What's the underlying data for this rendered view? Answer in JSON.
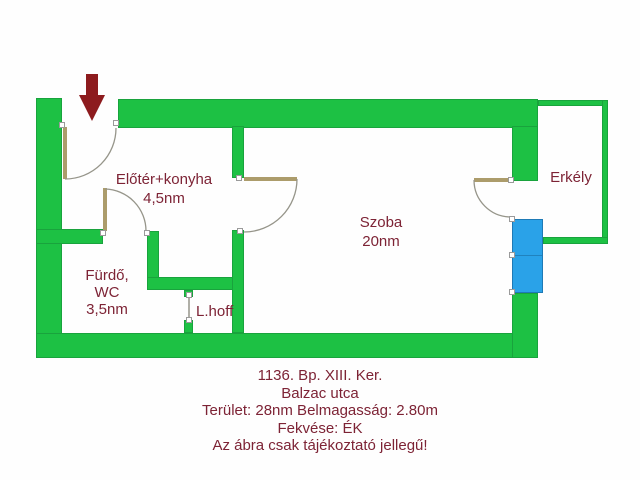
{
  "rooms": {
    "entry_kitchen": {
      "name": "Előtér+konyha",
      "area": "4,5nm"
    },
    "living_room": {
      "name": "Szoba",
      "area": "20nm"
    },
    "balcony": {
      "name": "Erkély"
    },
    "bathroom": {
      "name_line1": "Fürdő,",
      "name_line2": "WC",
      "area": "3,5nm"
    },
    "light_shaft": {
      "name": "L.hoff"
    }
  },
  "footer": {
    "line1": "1136. Bp. XIII. Ker.",
    "line2": "Balzac utca",
    "line3": "Terület: 28nm Belmagasság: 2.80m",
    "line4": "Fekvése: ÉK",
    "line5": "Az ábra csak tájékoztató jellegű!"
  },
  "icons": {
    "entrance_arrow": "down-arrow",
    "window": "window-glazing-bar",
    "door_jamb": "door-jamb-marker"
  },
  "colors": {
    "wall_green": "#1dc144",
    "window_blue": "#2aa2e8",
    "door_tan": "#ac9c6b",
    "arc_gray": "#96958a",
    "text_maroon": "#7d2335",
    "arrow_red": "#8d1b1e",
    "background": "#fefefe"
  }
}
